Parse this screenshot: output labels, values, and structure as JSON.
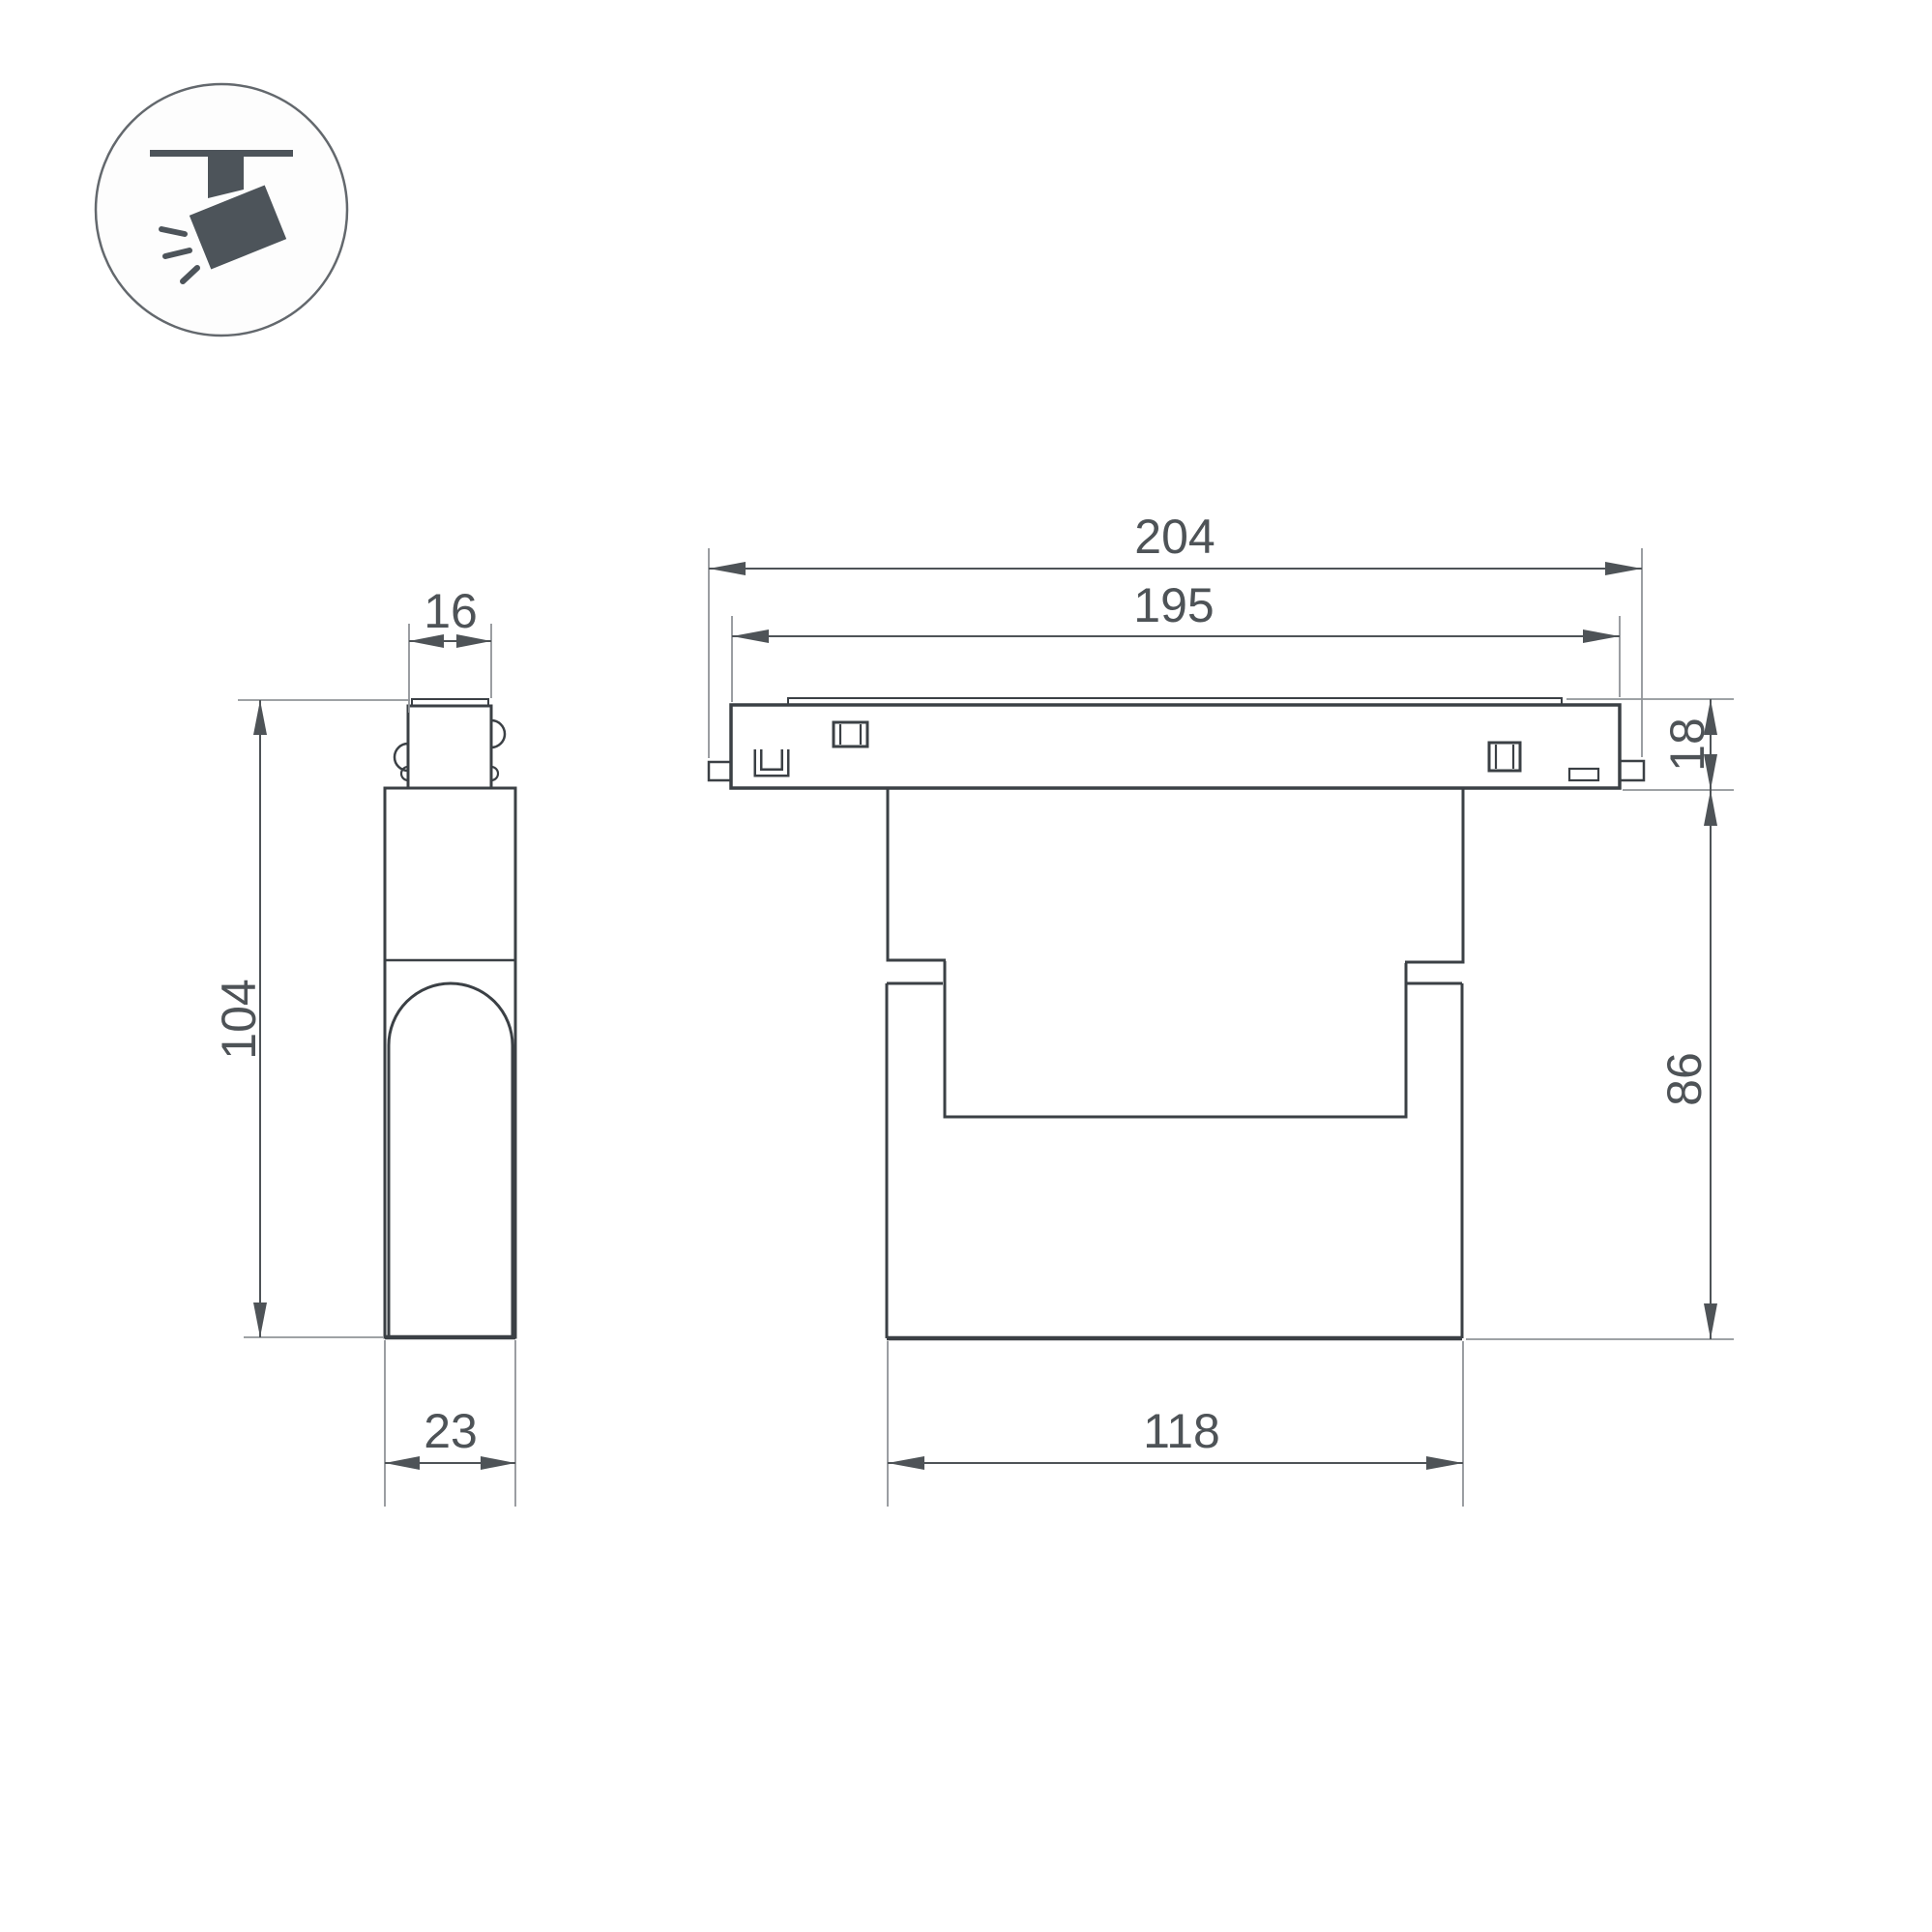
{
  "icon": {
    "name": "track-spotlight",
    "description": "ceiling track with tilted spotlight emitting light rays",
    "ray_count": 3
  },
  "colors": {
    "background": "#ffffff",
    "outline": "#3b4045",
    "dimension": "#4e5357",
    "extension": "#909498",
    "icon_fill": "#4d545a",
    "icon_circle_stroke": "#63686d"
  },
  "views": {
    "side": {
      "name": "side-view",
      "dims": {
        "top_width": "16",
        "height": "104",
        "depth": "23"
      }
    },
    "front": {
      "name": "front-view",
      "dims": {
        "overall_width": "204",
        "housing_width": "195",
        "track_height": "18",
        "body_height": "86",
        "body_width": "118"
      }
    }
  }
}
